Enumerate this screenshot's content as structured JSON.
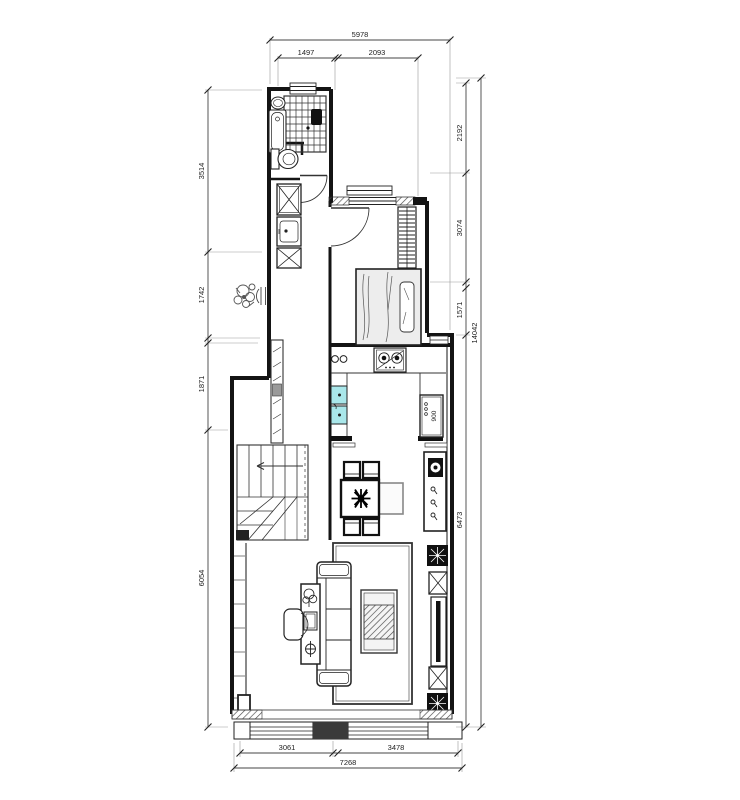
{
  "dims": {
    "top": {
      "total": "5978",
      "segments": [
        "1497",
        "2093"
      ]
    },
    "left": {
      "segments": [
        "3514",
        "1742",
        "1871",
        "6054"
      ]
    },
    "right": {
      "segments": [
        "2192",
        "3074",
        "1571",
        "6473"
      ],
      "total": "14042"
    },
    "bottom": {
      "segments": [
        "3061",
        "3478"
      ],
      "total": "7268"
    },
    "labels": {
      "cabinet_width": "900"
    }
  },
  "colors": {
    "wall": "#141414",
    "dimension_line": "#444444",
    "sink_fill": "#a9e7ea",
    "bed_fill": "#ededed",
    "glass_block": "#9a9a9a"
  }
}
